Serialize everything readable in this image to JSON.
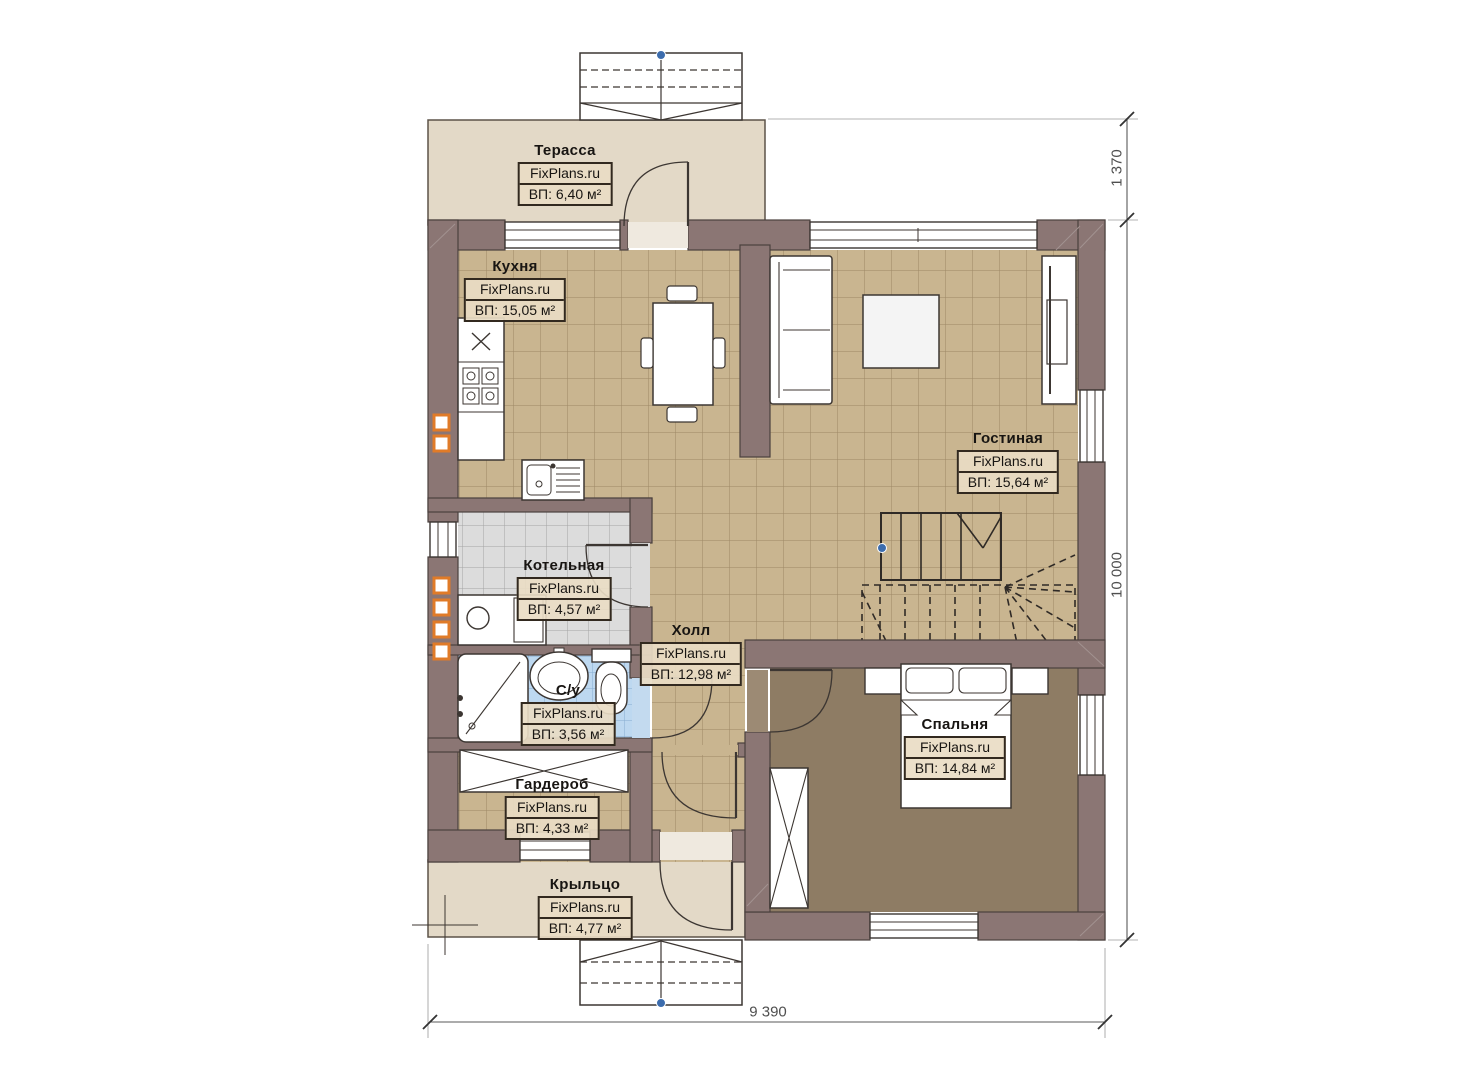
{
  "watermark": "FixPlans.ru",
  "rooms": [
    {
      "id": "terrace",
      "name": "Терасса",
      "area": "ВП: 6,40 м²"
    },
    {
      "id": "kitchen",
      "name": "Кухня",
      "area": "ВП: 15,05 м²"
    },
    {
      "id": "living",
      "name": "Гостиная",
      "area": "ВП: 15,64 м²"
    },
    {
      "id": "boiler",
      "name": "Котельная",
      "area": "ВП: 4,57 м²"
    },
    {
      "id": "hall",
      "name": "Холл",
      "area": "ВП: 12,98 м²"
    },
    {
      "id": "bath",
      "name": "С/у",
      "area": "ВП: 3,56 м²"
    },
    {
      "id": "wardrobe",
      "name": "Гардероб",
      "area": "ВП: 4,33 м²"
    },
    {
      "id": "bedroom",
      "name": "Спальня",
      "area": "ВП: 14,84 м²"
    },
    {
      "id": "porch",
      "name": "Крыльцо",
      "area": "ВП: 4,77 м²"
    }
  ],
  "dims": {
    "terrace_depth": "1 370",
    "house_depth": "10 000",
    "house_width": "9 390"
  },
  "colors": {
    "wall": "#8b7674",
    "floor_tile": "#c9b590",
    "bedroom_floor": "#8e7c64",
    "terrace_floor": "#e3d9c7",
    "bath_tile": "#bdd8f0",
    "boiler_tile": "#dbdbdb",
    "vent_accent": "#e07b28",
    "pivot_dot": "#3c6cad"
  }
}
